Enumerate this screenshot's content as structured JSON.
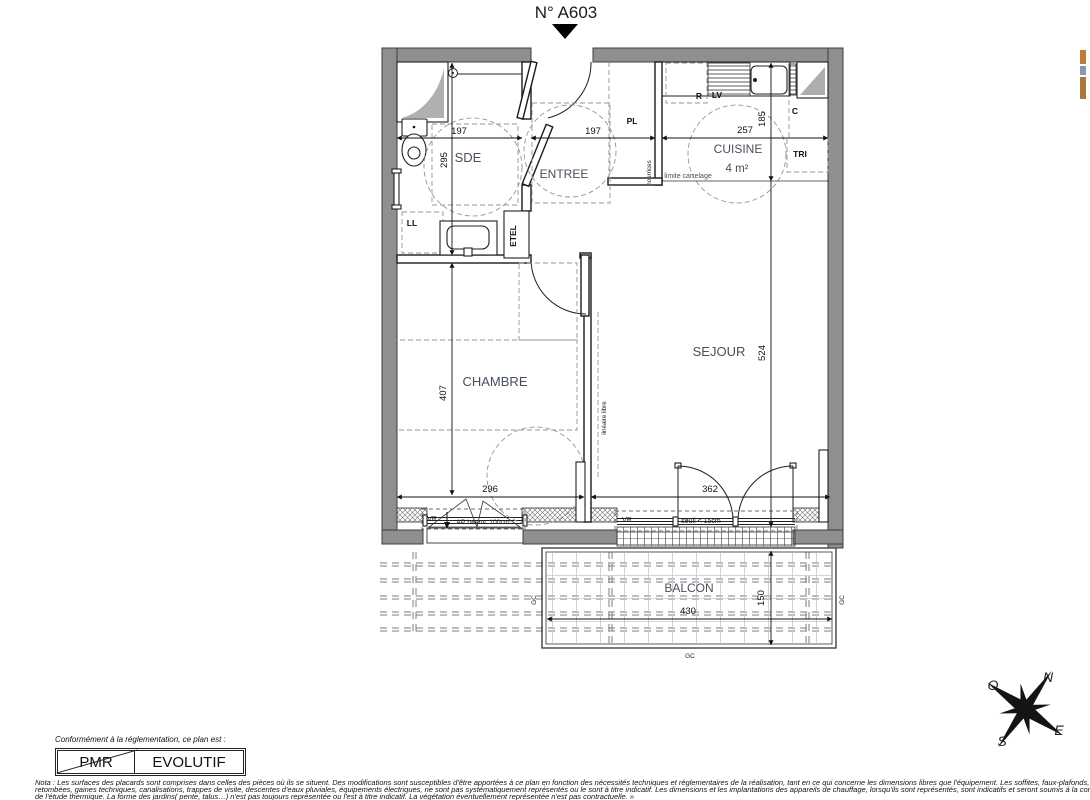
{
  "title": "N° A603",
  "rooms": {
    "sde": "SDE",
    "entree": "ENTREE",
    "cuisine": "CUISINE",
    "cuisine_area": "4 m²",
    "chambre": "CHAMBRE",
    "sejour": "SEJOUR",
    "balcon": "BALCON"
  },
  "fixtures": {
    "pl": "PL",
    "ll": "LL",
    "etel": "ETEL",
    "r": "R",
    "lv": "LV",
    "c": "C",
    "tri": "TRI"
  },
  "annotations": {
    "nourrices": "nourrices",
    "limite_carrelage": "limite carrelage",
    "lineaire_libre": "linéaire libre",
    "vr": "VR",
    "ap": "AP h=env. 100cm",
    "seuil": "seuil < 15cm",
    "gc": "GC"
  },
  "dims": {
    "sde_w": "197",
    "entree_w": "197",
    "cuisine_w": "257",
    "sde_h": "295",
    "cuisine_h": "185",
    "chambre_h": "407",
    "chambre_w": "296",
    "sejour_w": "362",
    "sejour_h": "524",
    "balcon_w": "430",
    "balcon_h": "150"
  },
  "compass": {
    "n": "N",
    "e": "E",
    "s": "S",
    "o": "O"
  },
  "conformity": {
    "intro": "Conformément à la réglementation, ce plan est :",
    "pmr": "PMR",
    "evolutif": "EVOLUTIF"
  },
  "nota": {
    "l1": "Nota : Les surfaces des placards sont comprises dans celles des pièces où ils se situent. Des modifications sont susceptibles d'être apportées à ce plan en fonction des nécessités techniques et réglementaires de la réalisation, tant en ce qui concerne les dimensions libres que l'équipement.  Les soffites, faux-plafonds,",
    "l2": "retombées, gaines techniques, canalisations, trappes de visite, descentes d'eaux pluviales, équipements électriques, ne sont pas systématiquement représentés ou le sont à titre indicatif. Les dimensions et les implantations des appareils de chauffage, lorsqu'ils sont représentés, sont indicatifs et seront soumis à la conformité",
    "l3": "de l'étude thermique. La forme des jardins( pente, talus…) n'est pas toujours représentée ou l'est à titre indicatif. La végétation éventuellement représentée n'est pas contractuelle. »"
  }
}
